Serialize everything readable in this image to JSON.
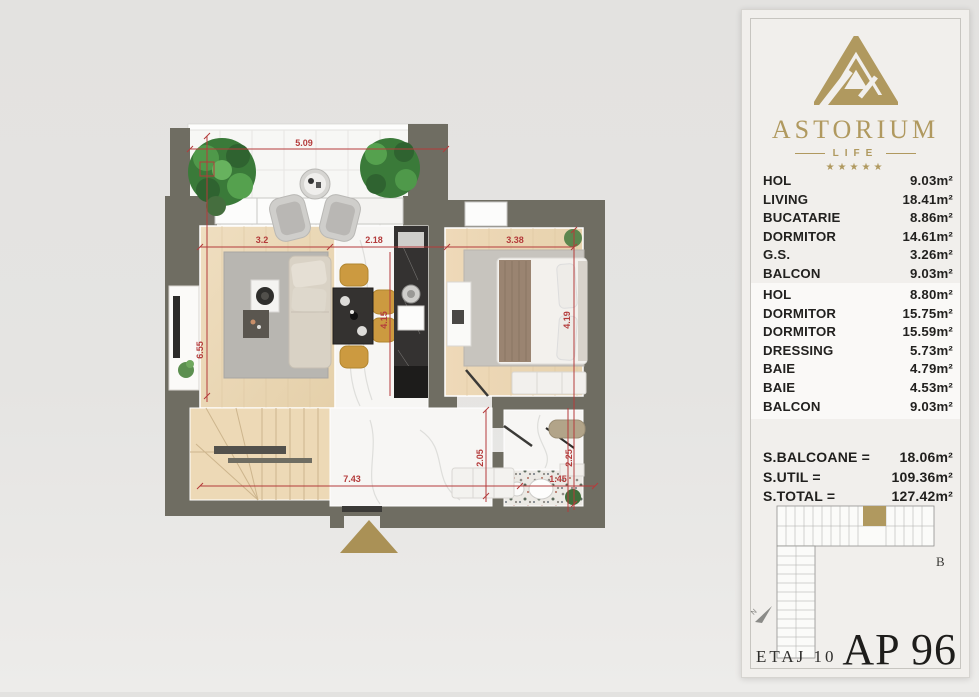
{
  "panel": {
    "brand": {
      "name": "ASTORIUM",
      "sub": "LIFE",
      "stars": "★★★★★"
    },
    "rooms_a": [
      {
        "label": "HOL",
        "value": "9.03m²"
      },
      {
        "label": "LIVING",
        "value": "18.41m²"
      },
      {
        "label": "BUCATARIE",
        "value": "8.86m²"
      },
      {
        "label": "DORMITOR",
        "value": "14.61m²"
      },
      {
        "label": "G.S.",
        "value": "3.26m²"
      },
      {
        "label": "BALCON",
        "value": "9.03m²"
      }
    ],
    "rooms_b": [
      {
        "label": "HOL",
        "value": "8.80m²"
      },
      {
        "label": "DORMITOR",
        "value": "15.75m²"
      },
      {
        "label": "DORMITOR",
        "value": "15.59m²"
      },
      {
        "label": "DRESSING",
        "value": "5.73m²"
      },
      {
        "label": "BAIE",
        "value": "4.79m²"
      },
      {
        "label": "BAIE",
        "value": "4.53m²"
      },
      {
        "label": "BALCON",
        "value": "9.03m²"
      }
    ],
    "totals": [
      {
        "label": "S.BALCOANE =",
        "value": "18.06m²"
      },
      {
        "label": "S.UTIL =",
        "value": "109.36m²"
      },
      {
        "label": "S.TOTAL =",
        "value": "127.42m²"
      }
    ],
    "keyplan_letter": "B",
    "north_letter": "N",
    "floor_label": "ETAJ 10",
    "apartment_label": "AP 96"
  },
  "plan": {
    "dimensions": {
      "balcony_width": "5.09",
      "living_width": "3.2",
      "kitchen_width": "2.18",
      "bedroom_width": "3.38",
      "living_height": "6.55",
      "dining_height": "4.15",
      "bedroom_height": "4.19",
      "hall_width": "7.43",
      "hall_height": "2.05",
      "bath_height": "2.25",
      "bath_width": "1.45"
    }
  },
  "colors": {
    "gold": "#b0995f",
    "dimension_red": "#b43b3b",
    "wall_gray": "#6f6d62"
  }
}
